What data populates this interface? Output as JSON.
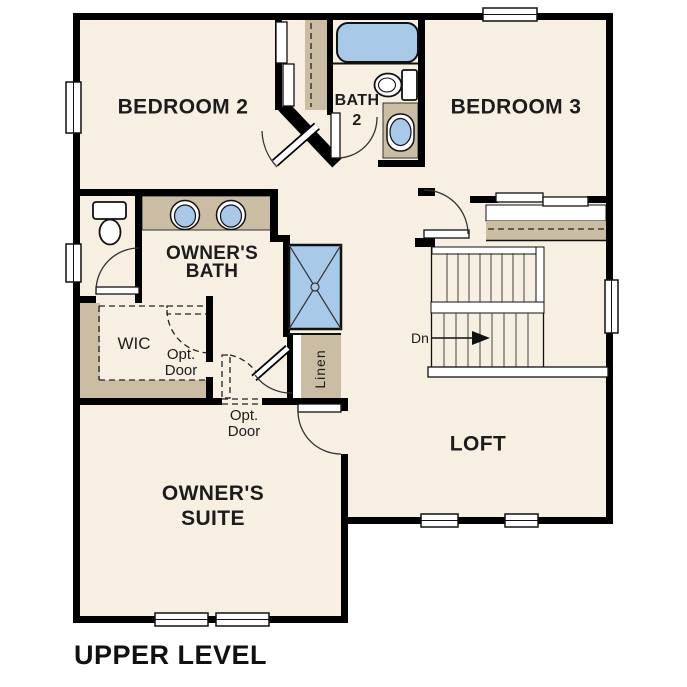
{
  "title": "UPPER LEVEL",
  "colors": {
    "floor": "#f7efe2",
    "tan": "#cbbda4",
    "blue": "#a9c9e9",
    "wall": "#000000",
    "ink": "#1c1c1c"
  },
  "rooms": {
    "bedroom2": "BEDROOM 2",
    "bedroom3": "BEDROOM 3",
    "bath2_line1": "BATH",
    "bath2_line2": "2",
    "owners_bath_line1": "OWNER'S",
    "owners_bath_line2": "BATH",
    "wic": "WIC",
    "owners_suite_line1": "OWNER'S",
    "owners_suite_line2": "SUITE",
    "loft": "LOFT",
    "linen": "Linen"
  },
  "annotations": {
    "opt_door_upper_line1": "Opt.",
    "opt_door_upper_line2": "Door",
    "opt_door_lower_line1": "Opt.",
    "opt_door_lower_line2": "Door",
    "stairs_direction": "Dn"
  }
}
